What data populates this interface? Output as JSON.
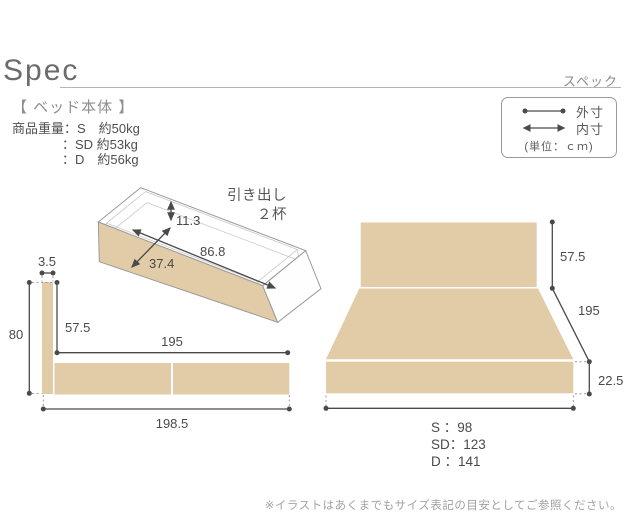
{
  "header": {
    "title": "Spec",
    "subtitle_jp": "スペック"
  },
  "section": {
    "label": "【 ベッド本体 】"
  },
  "weights": {
    "line1": "商品重量：S　約50kg",
    "line2": "：SD 約53kg",
    "line3": "：D　約56kg"
  },
  "legend": {
    "outer_label": "外寸",
    "inner_label": "内寸",
    "unit": "(単位：ｃｍ)"
  },
  "drawer": {
    "label_line1": "引き出し",
    "label_line2": "２杯",
    "inner_height": "11.3",
    "inner_length": "86.8",
    "inner_width": "37.4"
  },
  "side_view": {
    "headboard_thickness": "3.5",
    "total_height": "80",
    "headboard_above_base": "57.5",
    "frame_length": "195",
    "total_length": "198.5"
  },
  "front_view": {
    "headboard_height": "57.5",
    "bed_length": "195",
    "base_height": "22.5",
    "width_s": "S ：98",
    "width_sd": "SD：123",
    "width_d": "D ：141"
  },
  "footnote": "※イラストはあくまでもサイズ表記の目安としてご参照ください。",
  "colors": {
    "wood_beige": "#e2cba7",
    "measure_line": "#4a4a4a",
    "outline_gray": "#9b9b9b"
  }
}
